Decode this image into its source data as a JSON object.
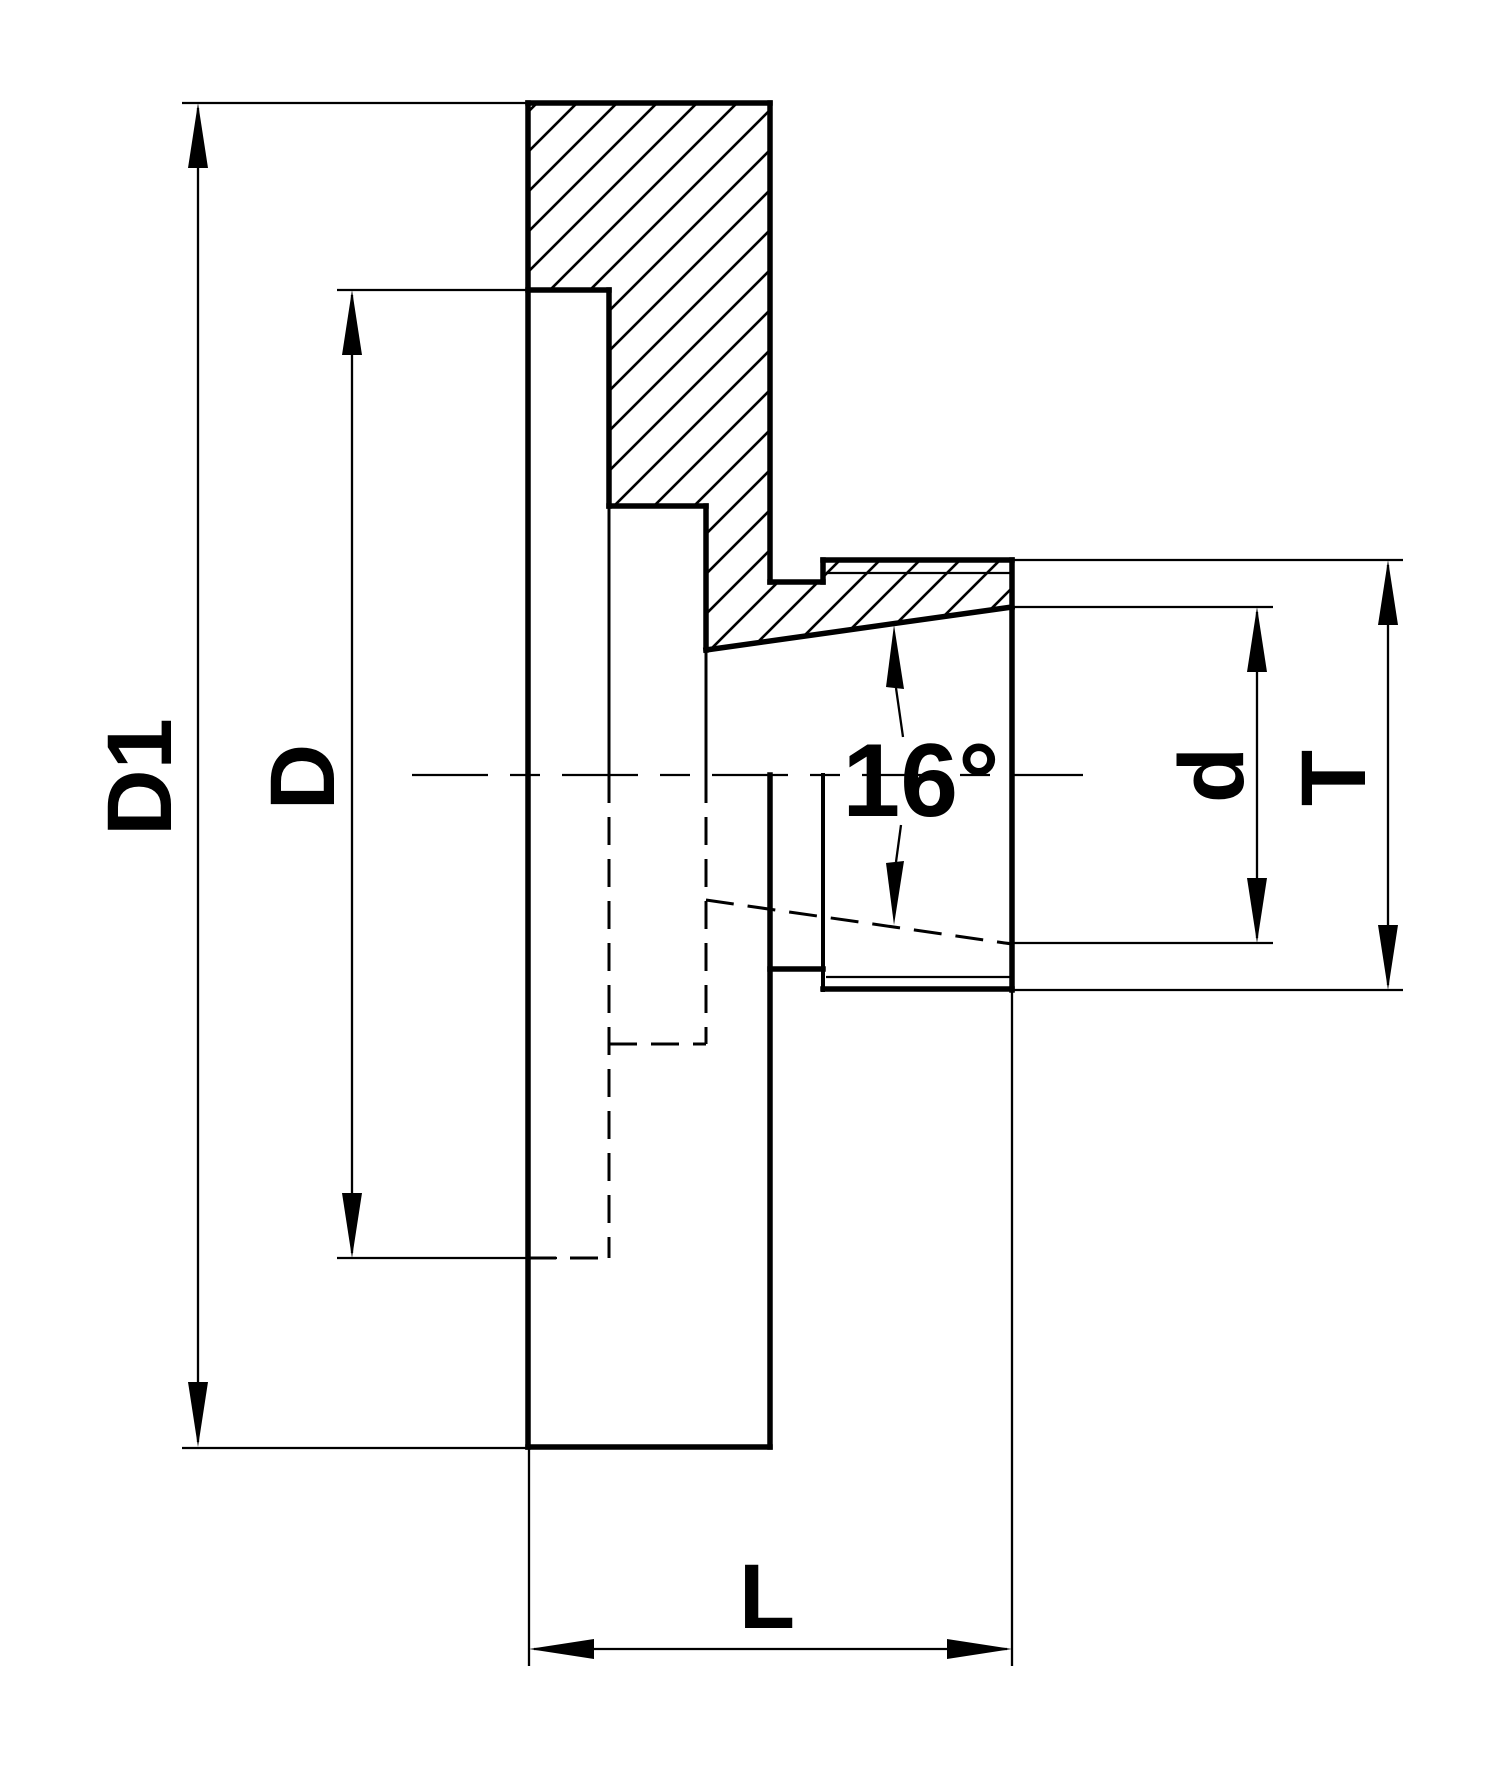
{
  "drawing": {
    "type": "technical-half-section",
    "part": "chuck backplate flange with 16-degree taper bore",
    "colors": {
      "line": "#000000",
      "background": "#ffffff"
    },
    "labels": {
      "flange_outer_diameter": "D1",
      "recess_diameter": "D",
      "taper_bore_diameter": "d",
      "spigot_diameter": "T",
      "overall_length": "L",
      "taper_angle": "16°"
    }
  }
}
